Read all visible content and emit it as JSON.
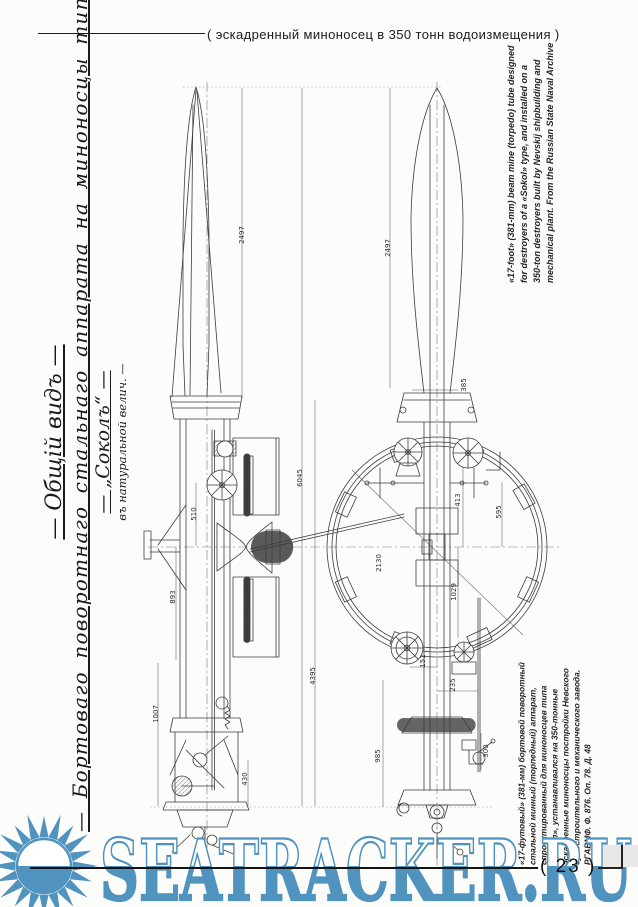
{
  "header": {
    "caption": "( эскадренный миноносец в 350 тонн водоизмещения )"
  },
  "title_block": {
    "line1": "— Общій видъ —",
    "line2": "— Бортоваго поворотнаго стальнаго аппарата на миноносцы типа —",
    "line3": "— „Соколъ“ —",
    "line4": "въ натуральной велич. —"
  },
  "caption_en": {
    "lines": [
      "«17-foot» (381-mm) beam mine (torpedo) tube designed",
      "for destroyers of a «Sokol» type, and installed on a",
      "350-ton destroyers built by Nevskij shipbuilding and",
      "mechanical plant. From the Russian State Naval Archive"
    ]
  },
  "caption_ru": {
    "lines": [
      "«17-футовый» (381-мм) бортовой поворотный",
      "стальной минный (торпедный) аппарат,",
      "спроектированный для миноносцев типа",
      "«Сокол», устанавливался на 350-тонные",
      "эскадренные миноносцы постройки Невского",
      "судостроительного и механического завода.",
      "РГАВМФ. Ф. 876. Оп. 78. Д. 48"
    ]
  },
  "watermark": {
    "text": "SEATRACKER.RU",
    "color": "#4F93BE"
  },
  "footer": {
    "page_number": "( 23 )"
  },
  "drawing": {
    "dims": [
      "2497",
      "6045",
      "4395",
      "1007",
      "510",
      "893",
      "430",
      "2497",
      "385",
      "2130",
      "595",
      "413",
      "1029",
      "151",
      "235",
      "300",
      "985"
    ]
  }
}
